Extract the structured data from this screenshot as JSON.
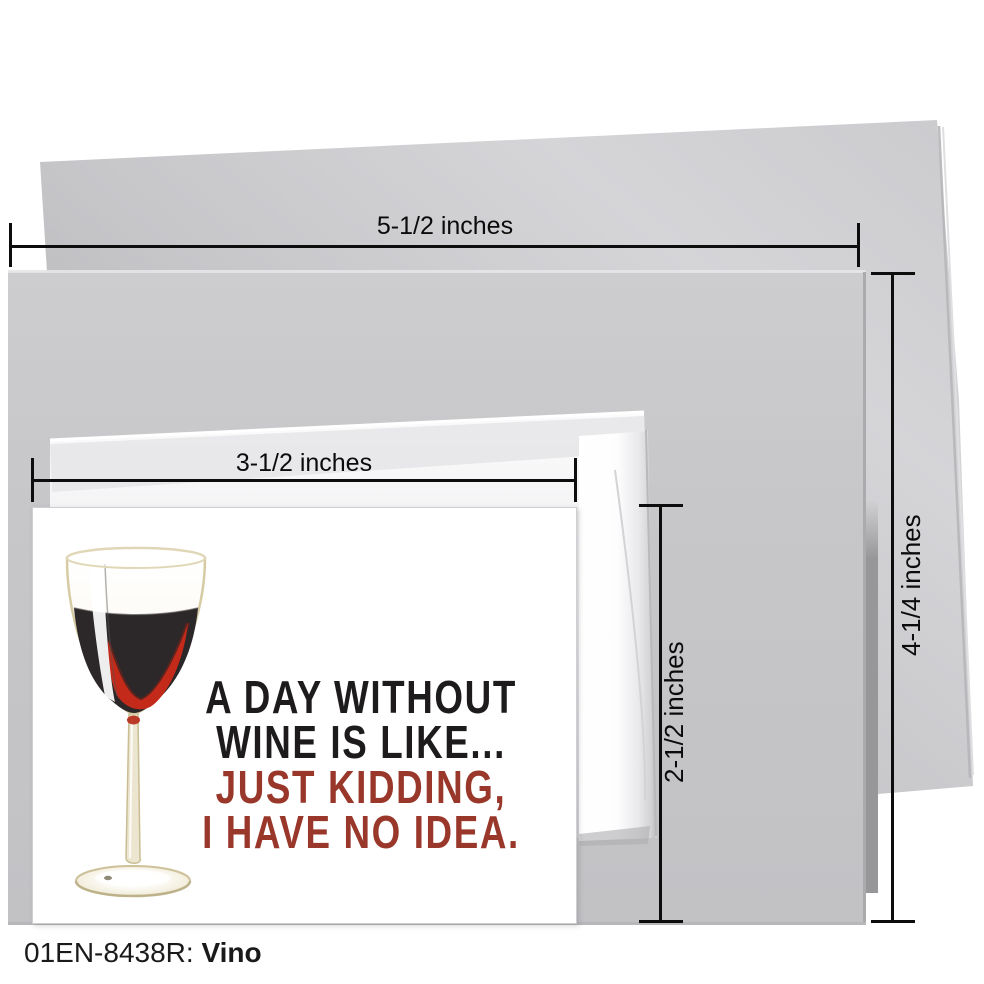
{
  "caption": {
    "sku": "01EN-8438R:",
    "name": "Vino"
  },
  "dimensions": {
    "envelope_width": "5-1/2 inches",
    "envelope_height": "4-1/4 inches",
    "card_width": "3-1/2 inches",
    "card_height": "2-1/2 inches"
  },
  "card": {
    "lines": [
      {
        "text": "A DAY WITHOUT",
        "color": "#1d1b1b"
      },
      {
        "text": "WINE IS LIKE...",
        "color": "#1d1b1b"
      },
      {
        "text": "JUST KIDDING,",
        "color": "#99372a"
      },
      {
        "text": "I HAVE NO IDEA.",
        "color": "#99372a"
      }
    ]
  },
  "colors": {
    "background": "#ffffff",
    "envelope_front": "#c7c7c9",
    "envelope_flap": "#c3c3c6",
    "small_envelope": "#f2f2f4",
    "dimension_line": "#0d0d0d",
    "wine_dark": "#2c282a",
    "wine_red": "#c42a19",
    "glass_outline": "#d6cba3"
  }
}
